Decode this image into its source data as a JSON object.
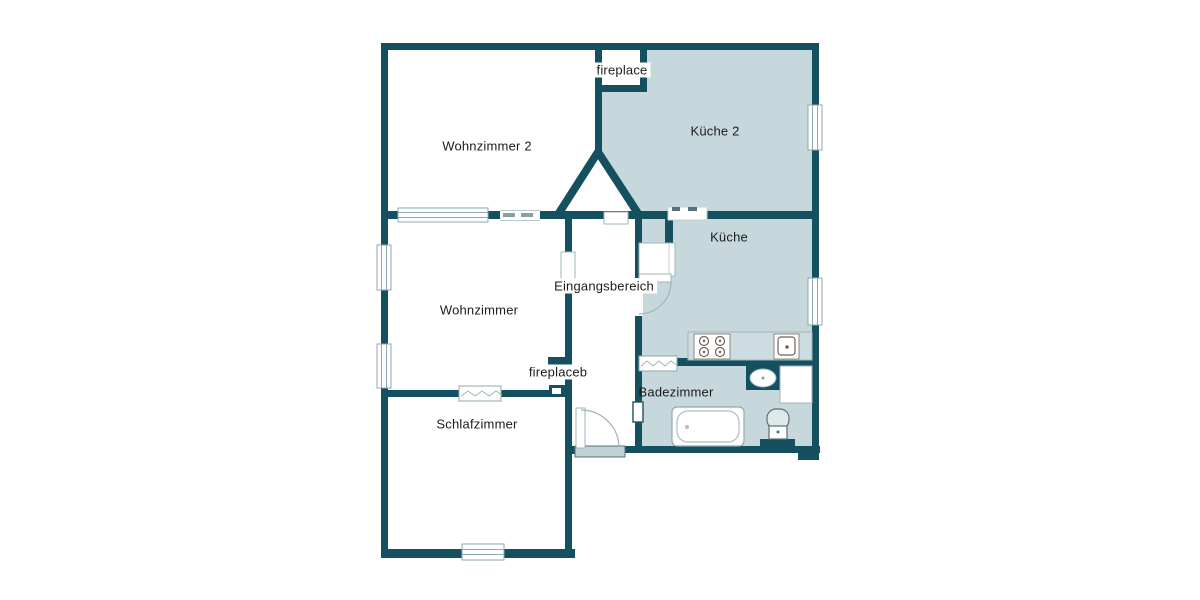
{
  "plan": {
    "labels": {
      "wohnzimmer2": "Wohnzimmer 2",
      "kueche2": "Küche 2",
      "kueche": "Küche",
      "wohnzimmer": "Wohnzimmer",
      "eingangsbereich": "Eingangsbereich",
      "schlafzimmer": "Schlafzimmer",
      "badezimmer": "Badezimmer",
      "fireplace": "fireplace",
      "fireplaceb": "fireplaceb"
    },
    "colors": {
      "wall": "#14505f",
      "room_fill": "#c6d8dc",
      "counter_fill": "#ccdce0",
      "window_line": "#8fa9ae",
      "threshold": "#c3d1d4",
      "label_text": "#1c1c1c",
      "background": "#ffffff"
    },
    "icons": {
      "stove-icon": "four-burner-cooktop",
      "kitchen-sink-icon": "square-sink-with-drain",
      "washbasin-icon": "oval-washbasin",
      "bathtub-icon": "bathtub",
      "toilet-icon": "toilet-with-cistern",
      "shower-icon": "shower-stall",
      "door-arc-icon": "door-swing-arc",
      "window-icon": "window-in-wall"
    }
  }
}
